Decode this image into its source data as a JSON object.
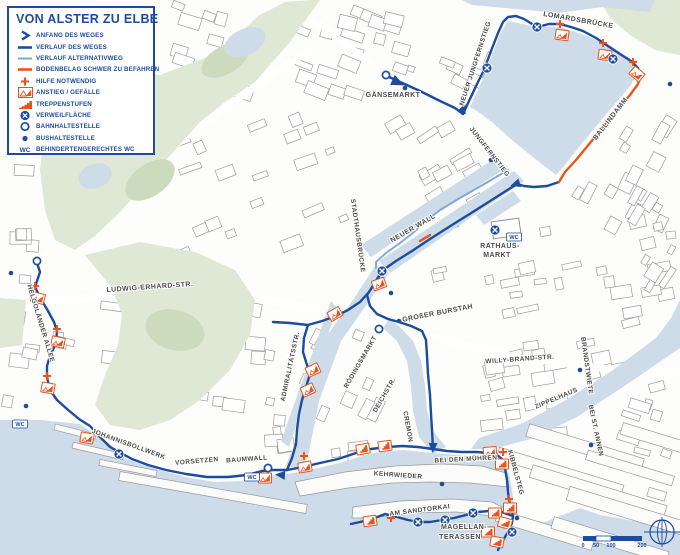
{
  "colors": {
    "accent_blue": "#1d4b9e",
    "route_main": "#1d4b9e",
    "route_alt": "#7fa8d9",
    "route_difficult": "#e8531d",
    "orange": "#e8531d",
    "water": "#cddce8",
    "park": "#dfe7d5",
    "building_stroke": "#9b9b9b",
    "label_gray": "#4a4a4a"
  },
  "legend": {
    "title": "VON ALSTER ZU ELBE",
    "wc_icon_text": "WC",
    "items": [
      {
        "type": "start-arrow",
        "label": "ANFANG DES WEGES"
      },
      {
        "type": "line-main",
        "label": "VERLAUF DES WEGES"
      },
      {
        "type": "line-alt",
        "label": "VERLAUF ALTERNATIVWEG"
      },
      {
        "type": "line-difficult",
        "label": "BODENBELAG SCHWER ZU BEFAHREN"
      },
      {
        "type": "help-plus",
        "label": "HILFE NOTWENDIG"
      },
      {
        "type": "incline",
        "label": "ANSTIEG / GEFÄLLE"
      },
      {
        "type": "steps",
        "label": "TREPPENSTUFEN"
      },
      {
        "type": "rest-area",
        "label": "VERWEILFLÄCHE"
      },
      {
        "type": "rail-stop",
        "label": "BAHNHALTESTELLE"
      },
      {
        "type": "bus-stop",
        "label": "BUSHALTESTELLE"
      },
      {
        "type": "wc",
        "label": "BEHINDERTENGERECHTES WC"
      }
    ]
  },
  "routes": {
    "main": [
      [
        [
          387,
          76
        ],
        [
          400,
          82
        ],
        [
          420,
          91
        ],
        [
          440,
          101
        ],
        [
          455,
          108
        ],
        [
          463,
          114
        ]
      ],
      [
        [
          463,
          114
        ],
        [
          469,
          101
        ],
        [
          477,
          84
        ],
        [
          484,
          70
        ],
        [
          491,
          51
        ],
        [
          498,
          33
        ],
        [
          503,
          22
        ],
        [
          508,
          17
        ],
        [
          516,
          16
        ],
        [
          524,
          19
        ],
        [
          537,
          27
        ],
        [
          549,
          24
        ],
        [
          560,
          24
        ],
        [
          571,
          27
        ],
        [
          583,
          31
        ],
        [
          596,
          38
        ],
        [
          608,
          46
        ],
        [
          620,
          54
        ],
        [
          631,
          61
        ],
        [
          638,
          68
        ],
        [
          641,
          76
        ]
      ],
      [
        [
          559,
          182
        ],
        [
          547,
          186
        ],
        [
          534,
          187
        ],
        [
          524,
          186
        ],
        [
          517,
          184
        ],
        [
          498,
          196
        ],
        [
          476,
          210
        ],
        [
          452,
          225
        ],
        [
          430,
          239
        ],
        [
          412,
          251
        ],
        [
          396,
          261
        ],
        [
          386,
          268
        ],
        [
          382,
          271
        ]
      ],
      [
        [
          382,
          271
        ],
        [
          376,
          281
        ],
        [
          369,
          292
        ],
        [
          367,
          295
        ],
        [
          370,
          306
        ],
        [
          377,
          314
        ],
        [
          388,
          319
        ],
        [
          399,
          322
        ],
        [
          411,
          326
        ],
        [
          422,
          331
        ],
        [
          426,
          340
        ],
        [
          427,
          356
        ],
        [
          428,
          374
        ],
        [
          430,
          395
        ],
        [
          431,
          414
        ],
        [
          432,
          430
        ],
        [
          433,
          449
        ]
      ],
      [
        [
          382,
          271
        ],
        [
          376,
          281
        ],
        [
          369,
          292
        ],
        [
          360,
          302
        ],
        [
          348,
          310
        ],
        [
          336,
          316
        ],
        [
          322,
          321
        ],
        [
          308,
          325
        ],
        [
          290,
          323
        ],
        [
          273,
          322
        ]
      ],
      [
        [
          308,
          325
        ],
        [
          304,
          338
        ],
        [
          303,
          352
        ],
        [
          307,
          365
        ],
        [
          310,
          374
        ],
        [
          306,
          387
        ],
        [
          302,
          400
        ],
        [
          299,
          414
        ],
        [
          297,
          430
        ],
        [
          296,
          444
        ],
        [
          292,
          458
        ],
        [
          287,
          470
        ]
      ],
      [
        [
          37,
          263
        ],
        [
          40,
          272
        ],
        [
          37,
          281
        ],
        [
          35,
          287
        ],
        [
          41,
          299
        ],
        [
          48,
          311
        ],
        [
          54,
          322
        ],
        [
          57,
          331
        ],
        [
          56,
          343
        ],
        [
          50,
          356
        ],
        [
          47,
          366
        ],
        [
          47,
          377
        ],
        [
          50,
          390
        ],
        [
          57,
          400
        ],
        [
          67,
          409
        ],
        [
          79,
          419
        ],
        [
          90,
          426
        ],
        [
          100,
          437
        ],
        [
          110,
          447
        ],
        [
          119,
          452
        ],
        [
          132,
          459
        ],
        [
          148,
          465
        ],
        [
          166,
          470
        ],
        [
          186,
          474
        ],
        [
          207,
          477
        ],
        [
          228,
          477
        ],
        [
          247,
          475
        ],
        [
          262,
          471
        ],
        [
          273,
          470
        ],
        [
          287,
          470
        ]
      ],
      [
        [
          287,
          470
        ],
        [
          303,
          467
        ],
        [
          320,
          463
        ],
        [
          338,
          459
        ],
        [
          356,
          453
        ],
        [
          371,
          449
        ],
        [
          387,
          447
        ],
        [
          403,
          446
        ],
        [
          418,
          447
        ],
        [
          433,
          449
        ],
        [
          447,
          451
        ],
        [
          462,
          452
        ],
        [
          477,
          452
        ],
        [
          489,
          453
        ],
        [
          497,
          455
        ],
        [
          502,
          459
        ],
        [
          505,
          468
        ],
        [
          507,
          480
        ],
        [
          508,
          492
        ],
        [
          509,
          500
        ],
        [
          511,
          509
        ],
        [
          513,
          516
        ]
      ],
      [
        [
          513,
          516
        ],
        [
          501,
          512
        ],
        [
          489,
          511
        ],
        [
          478,
          512
        ],
        [
          466,
          515
        ],
        [
          454,
          518
        ],
        [
          442,
          520
        ],
        [
          430,
          522
        ],
        [
          419,
          522
        ],
        [
          408,
          520
        ],
        [
          397,
          517
        ],
        [
          385,
          514
        ],
        [
          372,
          519
        ],
        [
          360,
          522
        ],
        [
          351,
          524
        ]
      ],
      [
        [
          513,
          516
        ],
        [
          512,
          523
        ],
        [
          509,
          530
        ],
        [
          505,
          537
        ],
        [
          501,
          544
        ],
        [
          498,
          550
        ]
      ]
    ],
    "alternative": [
      [
        [
          508,
          170
        ],
        [
          486,
          183
        ],
        [
          460,
          198
        ],
        [
          440,
          210
        ],
        [
          426,
          221
        ],
        [
          414,
          232
        ],
        [
          400,
          243
        ],
        [
          386,
          253
        ],
        [
          376,
          262
        ],
        [
          376,
          268
        ]
      ]
    ],
    "difficult": [
      [
        [
          641,
          76
        ],
        [
          638,
          84
        ],
        [
          630,
          95
        ],
        [
          618,
          109
        ],
        [
          604,
          126
        ],
        [
          590,
          143
        ],
        [
          576,
          160
        ],
        [
          565,
          172
        ],
        [
          559,
          182
        ]
      ],
      [
        [
          420,
          241
        ],
        [
          430,
          235
        ]
      ]
    ]
  },
  "markers": {
    "verweilflaeche": [
      [
        487,
        68
      ],
      [
        537,
        27
      ],
      [
        613,
        59
      ],
      [
        382,
        271
      ],
      [
        495,
        230
      ],
      [
        119,
        454
      ],
      [
        418,
        522
      ],
      [
        445,
        520
      ],
      [
        473,
        513
      ],
      [
        512,
        532
      ]
    ],
    "bahnhaltestelle": [
      [
        386,
        75
      ],
      [
        37,
        261
      ],
      [
        268,
        468
      ],
      [
        379,
        329
      ]
    ],
    "bushaltestelle": [
      [
        405,
        88
      ],
      [
        670,
        84
      ],
      [
        11,
        273
      ],
      [
        26,
        406
      ],
      [
        491,
        160
      ],
      [
        391,
        293
      ],
      [
        399,
        321
      ],
      [
        580,
        370
      ],
      [
        591,
        445
      ],
      [
        442,
        484
      ],
      [
        517,
        518
      ]
    ],
    "hilfe": [
      [
        560,
        24
      ],
      [
        603,
        43
      ],
      [
        633,
        62
      ],
      [
        35,
        286
      ],
      [
        57,
        329
      ],
      [
        47,
        376
      ],
      [
        304,
        456
      ],
      [
        503,
        452
      ],
      [
        509,
        499
      ],
      [
        391,
        518
      ]
    ],
    "anstieg": [
      [
        562,
        35,
        8
      ],
      [
        605,
        55,
        8
      ],
      [
        637,
        74,
        40
      ],
      [
        38,
        298,
        15
      ],
      [
        58,
        342,
        12
      ],
      [
        48,
        388,
        10
      ],
      [
        379,
        284,
        -20
      ],
      [
        335,
        314,
        -30
      ],
      [
        313,
        370,
        -25
      ],
      [
        308,
        390,
        -25
      ],
      [
        305,
        467,
        -10
      ],
      [
        265,
        478,
        0
      ],
      [
        87,
        438,
        10
      ],
      [
        490,
        452,
        -5
      ]
    ],
    "treppen": [
      [
        363,
        449,
        -10
      ],
      [
        385,
        446,
        -8
      ],
      [
        502,
        464,
        0
      ],
      [
        510,
        508,
        0
      ],
      [
        495,
        513,
        0
      ],
      [
        505,
        523,
        15
      ],
      [
        488,
        532,
        0
      ],
      [
        497,
        542,
        10
      ],
      [
        370,
        521,
        -8
      ]
    ],
    "wc": [
      [
        20,
        424
      ],
      [
        252,
        477
      ],
      [
        514,
        237
      ]
    ],
    "wc_label": "WC",
    "arrows": [
      [
        463,
        109,
        -68
      ],
      [
        516,
        184,
        162
      ],
      [
        281,
        475,
        185
      ],
      [
        433,
        447,
        92
      ]
    ],
    "start_arrow": [
      397,
      82,
      25
    ]
  },
  "street_labels": [
    {
      "text": "GÄNSEMARKT",
      "x": 393,
      "y": 97,
      "rot": 0,
      "size": 7
    },
    {
      "text": "NEUER JUNGFERNSTIEG",
      "x": 477,
      "y": 64,
      "rot": -72,
      "size": 6.5
    },
    {
      "text": "LOMARDSBRÜCKE",
      "x": 578,
      "y": 22,
      "rot": 10,
      "size": 7
    },
    {
      "text": "JUNGFERNSTIEG",
      "x": 488,
      "y": 153,
      "rot": 52,
      "size": 6.5
    },
    {
      "text": "BALLINDAMM",
      "x": 612,
      "y": 120,
      "rot": -52,
      "size": 7
    },
    {
      "text": "STADTHAUSBRÜCKE",
      "x": 356,
      "y": 236,
      "rot": 82,
      "size": 6.5
    },
    {
      "text": "NEUER WALL",
      "x": 414,
      "y": 230,
      "rot": -30,
      "size": 7
    },
    {
      "text": "RATHAUS-",
      "x": 500,
      "y": 248,
      "rot": 0,
      "size": 7
    },
    {
      "text": "MARKT",
      "x": 497,
      "y": 257,
      "rot": 0,
      "size": 7
    },
    {
      "text": "GROßER BURSTAH",
      "x": 438,
      "y": 315,
      "rot": -11,
      "size": 7
    },
    {
      "text": "LUDWIG-ERHARD-STR.",
      "x": 150,
      "y": 289,
      "rot": -4,
      "size": 7
    },
    {
      "text": "HELGOLÄNDER ALLEE",
      "x": 39,
      "y": 324,
      "rot": 73,
      "size": 6.5
    },
    {
      "text": "WILLY-BRAND-STR.",
      "x": 520,
      "y": 361,
      "rot": -4,
      "size": 6.5
    },
    {
      "text": "BRANDSTWIETE",
      "x": 585,
      "y": 366,
      "rot": 82,
      "size": 6.5
    },
    {
      "text": "ZIPPELHAUS",
      "x": 557,
      "y": 400,
      "rot": -23,
      "size": 6.5
    },
    {
      "text": "BEI ST. ANNEN",
      "x": 594,
      "y": 431,
      "rot": 78,
      "size": 6.5
    },
    {
      "text": "JOHANNISBOLLWERK",
      "x": 128,
      "y": 446,
      "rot": 20,
      "size": 6.5
    },
    {
      "text": "VORSETZEN",
      "x": 197,
      "y": 463,
      "rot": -5,
      "size": 6.5
    },
    {
      "text": "BAUMWALL",
      "x": 247,
      "y": 461,
      "rot": -4,
      "size": 6.5
    },
    {
      "text": "KEHRWIEDER",
      "x": 398,
      "y": 477,
      "rot": 4,
      "size": 6.5
    },
    {
      "text": "BEI DEN MÜHREN",
      "x": 466,
      "y": 461,
      "rot": -3,
      "size": 6.5
    },
    {
      "text": "KIBBELSTEG",
      "x": 514,
      "y": 473,
      "rot": 75,
      "size": 6.5
    },
    {
      "text": "AM SANDTORKAI",
      "x": 420,
      "y": 512,
      "rot": -7,
      "size": 6.5
    },
    {
      "text": "MAGELLAN-",
      "x": 464,
      "y": 529,
      "rot": 0,
      "size": 7
    },
    {
      "text": "TERASSEN",
      "x": 460,
      "y": 539,
      "rot": 0,
      "size": 7
    },
    {
      "text": "CREMON",
      "x": 406,
      "y": 427,
      "rot": 80,
      "size": 6.5
    },
    {
      "text": "DEICHSTR.",
      "x": 386,
      "y": 396,
      "rot": -60,
      "size": 6.5
    },
    {
      "text": "RÖDINGSMARKT",
      "x": 362,
      "y": 363,
      "rot": -60,
      "size": 6.5
    },
    {
      "text": "ADMIRALITÄTSSTR.",
      "x": 292,
      "y": 367,
      "rot": -78,
      "size": 6.5
    }
  ],
  "scale_bar": {
    "labels": [
      "0",
      "50",
      "100",
      "200"
    ],
    "label_x": [
      583,
      596,
      611,
      642
    ],
    "label_y": 547
  }
}
